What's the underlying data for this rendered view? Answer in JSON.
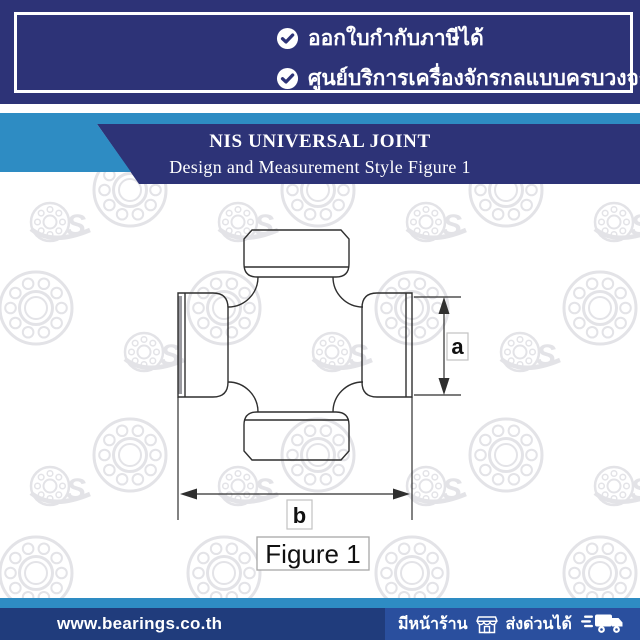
{
  "colors": {
    "navy": "#2d3377",
    "lightblue": "#2e8cc3",
    "footer_navy": "#203c7c",
    "footer_panel": "#2a4f9e",
    "watermark": "#e3e3e7",
    "line": "#2f2f2f"
  },
  "top_banner": {
    "items": [
      {
        "icon": "check-circle-icon",
        "label": "ออกใบกำกับภาษีได้"
      },
      {
        "icon": "check-circle-icon",
        "label": "ศูนย์บริการเครื่องจักรกลแบบครบวงจร"
      }
    ]
  },
  "header": {
    "title": "NIS UNIVERSAL JOINT",
    "subtitle": "Design and Measurement Style Figure 1"
  },
  "figure": {
    "dimension_a_label": "a",
    "dimension_b_label": "b",
    "caption": "Figure 1"
  },
  "footer": {
    "website": "www.bearings.co.th",
    "badges": [
      {
        "icon": "storefront-icon",
        "label": "มีหน้าร้าน"
      },
      {
        "icon": "delivery-truck-icon",
        "label": "ส่งด่วนได้"
      }
    ]
  }
}
